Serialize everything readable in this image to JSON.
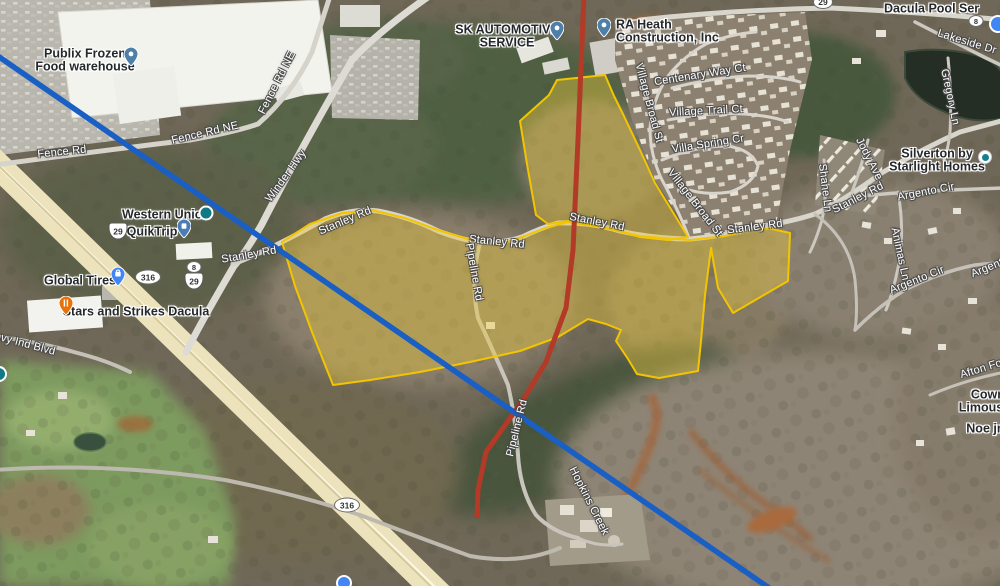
{
  "overlay_colors": {
    "parcel_fill": "#E9C83C",
    "parcel_stroke": "#F2C500",
    "pipeline_line_red": "#B23A26",
    "boundary_line_blue": "#1A5FC4"
  },
  "road_labels": [
    {
      "text": "Fence Rd"
    },
    {
      "text": "Fence Rd NE"
    },
    {
      "text": "Fence Rd NE"
    },
    {
      "text": "Winder Hwy"
    },
    {
      "text": "Stanley Rd"
    },
    {
      "text": "Stanley Rd"
    },
    {
      "text": "Stanley Rd"
    },
    {
      "text": "Stanley Rd"
    },
    {
      "text": "Stanley Rd"
    },
    {
      "text": "Stanley Rd"
    },
    {
      "text": "Pipeline Rd"
    },
    {
      "text": "Pipeline Rd"
    },
    {
      "text": "Hopkins Creek"
    },
    {
      "text": "Jody Ave"
    },
    {
      "text": "Shane Ln"
    },
    {
      "text": "Animas Ln"
    },
    {
      "text": "Argento Cir"
    },
    {
      "text": "Argento Cir"
    },
    {
      "text": "Argento"
    },
    {
      "text": "Afton Fo"
    },
    {
      "text": "Lakeside Dr"
    },
    {
      "text": "Gregory Ln"
    },
    {
      "text": "Centenary Way Ct"
    },
    {
      "text": "Village Broad St"
    },
    {
      "text": "Village Trail Ct"
    },
    {
      "text": "Villa Spring Cr"
    },
    {
      "text": "Village Broad St"
    },
    {
      "text": "ovy Ind Blvd"
    }
  ],
  "poi_labels": [
    {
      "lines": [
        "Publix Frozen",
        "Food warehouse"
      ]
    },
    {
      "lines": [
        "SK AUTOMOTIVE",
        "SERVICE"
      ]
    },
    {
      "lines": [
        "RA Heath",
        "Construction, Inc"
      ]
    },
    {
      "lines": [
        "Dacula Pool Ser"
      ]
    },
    {
      "lines": [
        "Western Union"
      ]
    },
    {
      "lines": [
        "QuikTrip"
      ]
    },
    {
      "lines": [
        "Global Tires"
      ]
    },
    {
      "lines": [
        "Stars and Strikes Dacula"
      ]
    },
    {
      "lines": [
        "Silverton by",
        "Starlight Homes"
      ]
    },
    {
      "lines": [
        "Cowry",
        "Limousine"
      ]
    },
    {
      "lines": [
        "Noe jr"
      ]
    }
  ],
  "shields": [
    {
      "route": "29"
    },
    {
      "route": "8"
    },
    {
      "route": "29"
    },
    {
      "route": "316"
    },
    {
      "route": "316"
    },
    {
      "route": "8"
    },
    {
      "route": "29"
    }
  ]
}
